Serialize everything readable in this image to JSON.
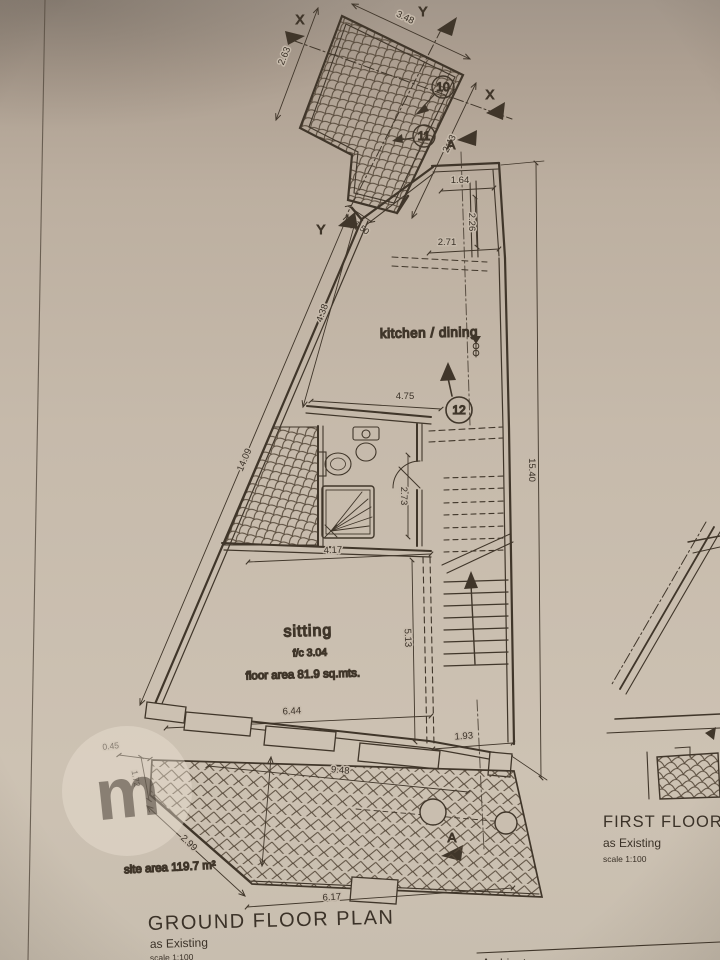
{
  "palette": {
    "paper": "#c6baab",
    "paper_dark": "#a89a8b",
    "ink": "#3b3228"
  },
  "titles": {
    "ground_title": "GROUND FLOOR PLAN",
    "ground_subtitle": "as Existing",
    "ground_scale": "scale 1:100",
    "first_title": "FIRST FLOOR",
    "first_subtitle": "as Existing",
    "first_scale": "scale 1:100",
    "site_area": "site area 119.7 m²",
    "corner_box_label": "Ambjent"
  },
  "rooms": {
    "kitchen": "kitchen / dining",
    "sitting": "sitting",
    "sitting_ceiling": "f/c 3.04",
    "sitting_area": "floor area 81.9 sq.mts."
  },
  "markers": {
    "section_x": "X",
    "section_y": "Y",
    "section_a": "A",
    "note_10": "10",
    "note_11": "11",
    "note_12": "12"
  },
  "dims": {
    "court_top": "3.48",
    "court_left": "2.63",
    "court_right": "2.43",
    "court_neck": "1.50",
    "terrace_width": "1.64",
    "terrace_height": "2.26",
    "kitchen_top": "2.71",
    "kitchen_left": "4.38",
    "kitchen_bottom": "4.75",
    "side_left_total": "14.09",
    "side_right_total": "15.40",
    "bath_height": "2.73",
    "bath_width": "4.17",
    "sitting_width": "6.44",
    "sitting_height": "5.13",
    "stair_width": "1.93",
    "yard_step": "0.45",
    "yard_left": "1.72",
    "front_width": "9.48",
    "yard_diagonal": "2.99",
    "yard_bottom": "6.17"
  },
  "watermark": "m"
}
